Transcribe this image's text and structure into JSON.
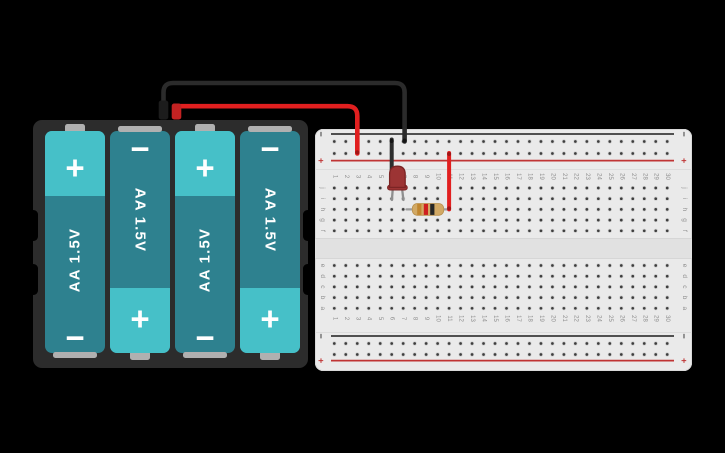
{
  "canvas": {
    "background": "#000000",
    "width": 725,
    "height": 453
  },
  "battery_pack": {
    "batteries": [
      {
        "label": "AA 1.5V",
        "top_symbol": "+",
        "bottom_symbol": "−",
        "orientation": "plus-top"
      },
      {
        "label": "AA 1.5V",
        "top_symbol": "−",
        "bottom_symbol": "+",
        "orientation": "plus-bottom"
      },
      {
        "label": "AA 1.5V",
        "top_symbol": "+",
        "bottom_symbol": "−",
        "orientation": "plus-top"
      },
      {
        "label": "AA 1.5V",
        "top_symbol": "−",
        "bottom_symbol": "+",
        "orientation": "plus-bottom"
      }
    ],
    "colors": {
      "case": "#2c2c2c",
      "body": "#2e818f",
      "cap": "#46c0c8",
      "text": "#ffffff",
      "terminal": "#b0b0b0"
    }
  },
  "breadboard": {
    "column_numbers": [
      "1",
      "2",
      "3",
      "4",
      "5",
      "6",
      "7",
      "8",
      "9",
      "10",
      "11",
      "12",
      "13",
      "14",
      "15",
      "16",
      "17",
      "18",
      "19",
      "20",
      "21",
      "22",
      "23",
      "24",
      "25",
      "26",
      "27",
      "28",
      "29",
      "30"
    ],
    "row_labels_top": [
      "j",
      "i",
      "h",
      "g",
      "f"
    ],
    "row_labels_bottom": [
      "e",
      "d",
      "c",
      "b",
      "a"
    ],
    "rail_minus_symbol": "−",
    "rail_plus_symbol": "+",
    "colors": {
      "board": "#eaeaea",
      "channel": "#e1e1e1",
      "hole": "#3e3e3e",
      "hole_ring": "#cfcfcf",
      "label": "#8f8f8f",
      "rail_black": "#3a3a3a",
      "rail_red": "#c03434"
    }
  },
  "components": {
    "led": {
      "type": "LED",
      "body_color": "#9c3434",
      "outline_color": "#7b2424",
      "leg_color": "#8f8f8f"
    },
    "resistor": {
      "body_color": "#d2a964",
      "band_colors": [
        "#c1862f",
        "#cf1f1f",
        "#262626"
      ],
      "lead_color": "#9d9d9d"
    },
    "wires": [
      {
        "name": "battery-negative-wire",
        "color": "#2b2b2b"
      },
      {
        "name": "battery-positive-wire",
        "color": "#e11f1f"
      },
      {
        "name": "negative-rail-jumper",
        "color": "#2d2d2d"
      },
      {
        "name": "positive-rail-jumper",
        "color": "#e11f1f"
      }
    ],
    "plugs": {
      "negative": "#1c1c1c",
      "positive": "#c32222"
    }
  }
}
